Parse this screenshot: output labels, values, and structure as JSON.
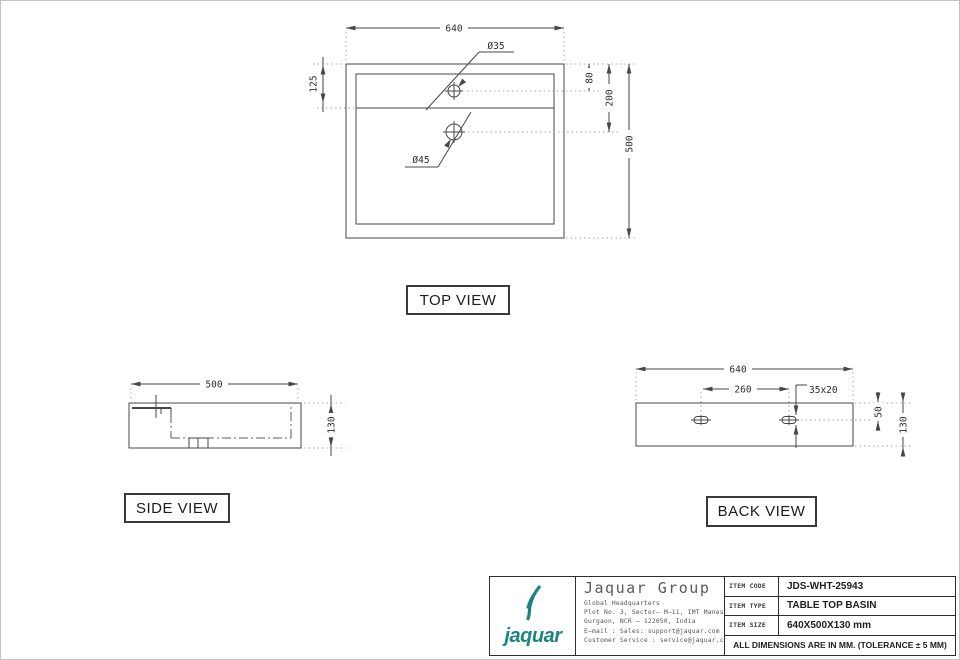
{
  "palette": {
    "teal": "#1e8480",
    "line": "#474747"
  },
  "views": {
    "top": {
      "label": "TOP VIEW",
      "dims": {
        "width": "640",
        "height": "500",
        "rim_offset": "125",
        "hole1_offset": "80",
        "hole2_offset": "200",
        "hole1_dia": "Ø35",
        "hole2_dia": "Ø45"
      }
    },
    "side": {
      "label": "SIDE VIEW",
      "dims": {
        "depth": "500",
        "height": "130"
      }
    },
    "back": {
      "label": "BACK VIEW",
      "dims": {
        "width": "640",
        "slot_spacing": "260",
        "slot_size": "35x20",
        "slot_top_offset": "50",
        "height": "130"
      }
    }
  },
  "title_block": {
    "logo_text": "jaquar",
    "company": "Jaquar Group",
    "address_lines": [
      "Global Headquarters",
      "Plot No. 3, Sector– M–11, IMT Manesar",
      "Gurgaon, NCR – 122050, India",
      "E–mail : Sales: support@jaquar.com",
      "Customer Service : service@jaquar.com"
    ],
    "rows": [
      {
        "label": "ITEM CODE",
        "value": "JDS-WHT-25943"
      },
      {
        "label": "ITEM TYPE",
        "value": "TABLE TOP BASIN"
      },
      {
        "label": "ITEM SIZE",
        "value": "640X500X130 mm"
      }
    ],
    "note": "ALL DIMENSIONS ARE IN MM. (TOLERANCE ± 5 MM)"
  }
}
